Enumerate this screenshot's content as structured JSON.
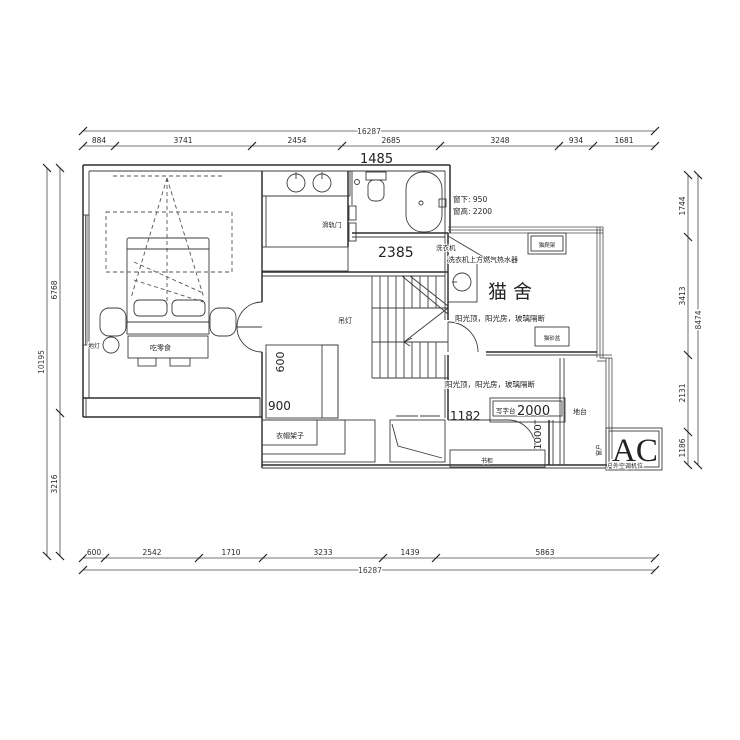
{
  "drawing_type": "apartment floor plan (CAD)",
  "dimensions": {
    "top": {
      "overall": "16287",
      "segments": [
        "884",
        "3741",
        "2454",
        "2685",
        "3248",
        "934",
        "1681"
      ]
    },
    "bottom": {
      "overall": "16287",
      "segments": [
        "600",
        "2542",
        "1710",
        "3233",
        "1439",
        "5863"
      ]
    },
    "left": {
      "overall": "10195",
      "segments": [
        "6768",
        "3216"
      ]
    },
    "right": {
      "overall": "8474",
      "segments": [
        "1744",
        "3413",
        "2131",
        "1186"
      ]
    }
  },
  "annotations": {
    "dim_1485": "1485",
    "dim_2385": "2385",
    "dim_900": "900",
    "dim_600": "600",
    "dim_1182": "1182",
    "dim_1000": "1000",
    "dim_2000": "2000",
    "window_note_line1": "窗下: 950",
    "window_note_line2": "窗高: 2200",
    "sliding_door": "滑轨门",
    "pendant_lamp": "吊灯",
    "floor_lamp": "地灯",
    "snack_bench": "吃零食",
    "coat_rack": "衣帽架子",
    "desk": "写字台",
    "platform": "地台",
    "window": "窗户",
    "ac": "AC",
    "ac_note": "户外空调机位",
    "bookcase": "书柜",
    "cat_house": "猫舍",
    "cat_tree": "猫爬架",
    "litter_box": "猫砂盆",
    "washing_machine": "洗衣机",
    "water_heater": "洗衣机上方燃气热水器",
    "sunroom_note_upper": "阳光顶，阳光房，玻璃隔断",
    "sunroom_note_lower": "阳光顶，阳光房，玻璃隔断"
  },
  "colors": {
    "line": "#2e2e2e",
    "background": "#ffffff"
  }
}
